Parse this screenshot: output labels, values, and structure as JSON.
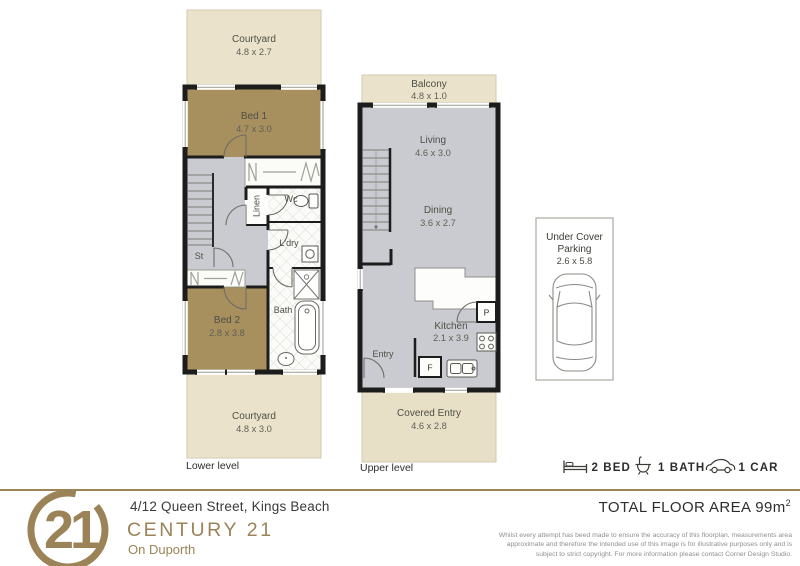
{
  "colors": {
    "brand_gold": "#9c8357",
    "courtyard_beige": "#eae2cb",
    "bedroom_tan": "#a78f5e",
    "floor_gray": "#c9cbd0",
    "wall_black": "#1c1c1c"
  },
  "lower": {
    "label": "Lower level",
    "rooms": {
      "courtyard_top": {
        "name": "Courtyard",
        "dims": "4.8 x 2.7"
      },
      "bed1": {
        "name": "Bed 1",
        "dims": "4.7 x 3.0"
      },
      "linen": {
        "name": "Linen"
      },
      "wc": {
        "name": "Wc"
      },
      "ldry": {
        "name": "L'dry"
      },
      "st": {
        "name": "St"
      },
      "bed2": {
        "name": "Bed 2",
        "dims": "2.8 x 3.8"
      },
      "bath": {
        "name": "Bath"
      },
      "courtyard_bottom": {
        "name": "Courtyard",
        "dims": "4.8 x 3.0"
      }
    }
  },
  "upper": {
    "label": "Upper level",
    "rooms": {
      "balcony": {
        "name": "Balcony",
        "dims": "4.8 x 1.0"
      },
      "living": {
        "name": "Living",
        "dims": "4.6 x 3.0"
      },
      "dining": {
        "name": "Dining",
        "dims": "3.6 x 2.7"
      },
      "kitchen": {
        "name": "Kitchen",
        "dims": "2.1 x 3.9"
      },
      "entry": {
        "name": "Entry"
      },
      "pantry": {
        "name": "P"
      },
      "fridge": {
        "name": "F"
      },
      "covered_entry": {
        "name": "Covered Entry",
        "dims": "4.6 x 2.8"
      }
    }
  },
  "parking": {
    "title_line1": "Under Cover",
    "title_line2": "Parking",
    "dims": "2.6 x 5.8"
  },
  "legend": {
    "bed_label": "2 BED",
    "bath_label": "1 BATH",
    "car_label": "1 CAR"
  },
  "footer": {
    "logo_number": "21",
    "address": "4/12 Queen Street, Kings Beach",
    "brand": "CENTURY 21",
    "office": "On Duporth",
    "total_area_label": "TOTAL FLOOR AREA 99m",
    "total_area_exp": "2",
    "disclaimer_line1": "Whilst every attempt has beed made to ensure the accuracy of this floorplan, measurements area",
    "disclaimer_line2": "approximate and therefore the intended use of this image is for illustrative purposes only and is",
    "disclaimer_line3": "subject to strict copyright. For more information please contact Corner Design Studio."
  }
}
